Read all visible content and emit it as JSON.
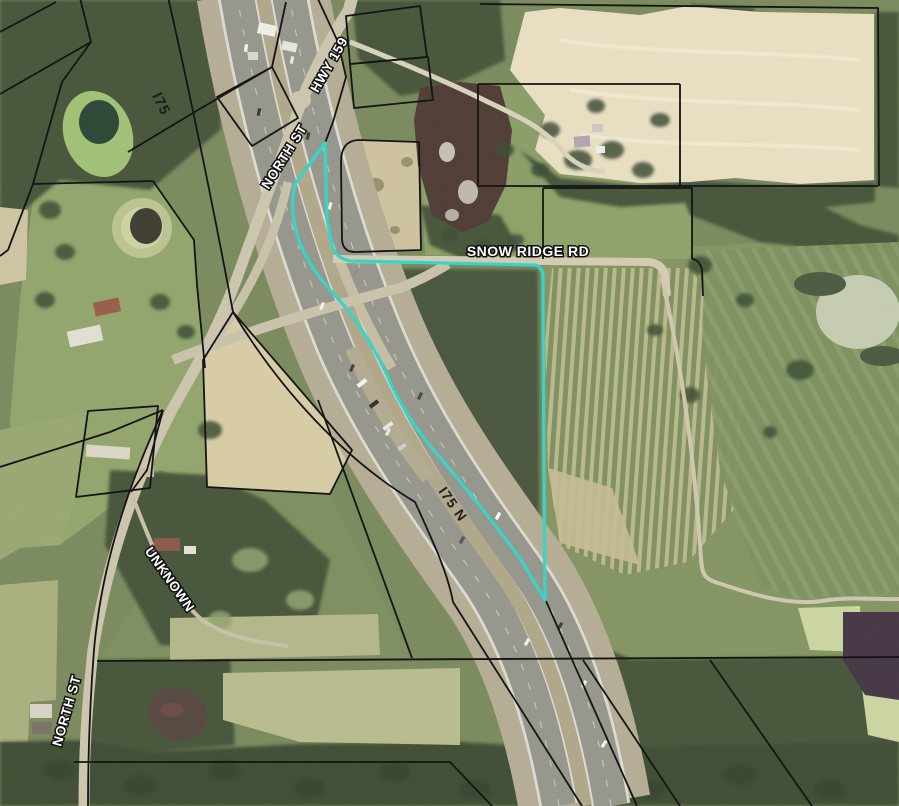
{
  "map": {
    "title": "Aerial parcel map with highlighted subject parcel",
    "highlight_color": "#35d6c8",
    "parcel_line_color": "#151515",
    "label_fill": "#ffffff",
    "label_halo": "#111111",
    "dark_label_fill": "#1d1d1d",
    "labels": {
      "i75": "I75",
      "hwy_159": "HWY 159",
      "north_st_top": "NORTH ST",
      "snow_ridge_rd": "SNOW RIDGE RD",
      "i75_n": "I75 N",
      "unknown": "UNKNOWN",
      "north_st_bottom": "NORTH ST"
    }
  }
}
